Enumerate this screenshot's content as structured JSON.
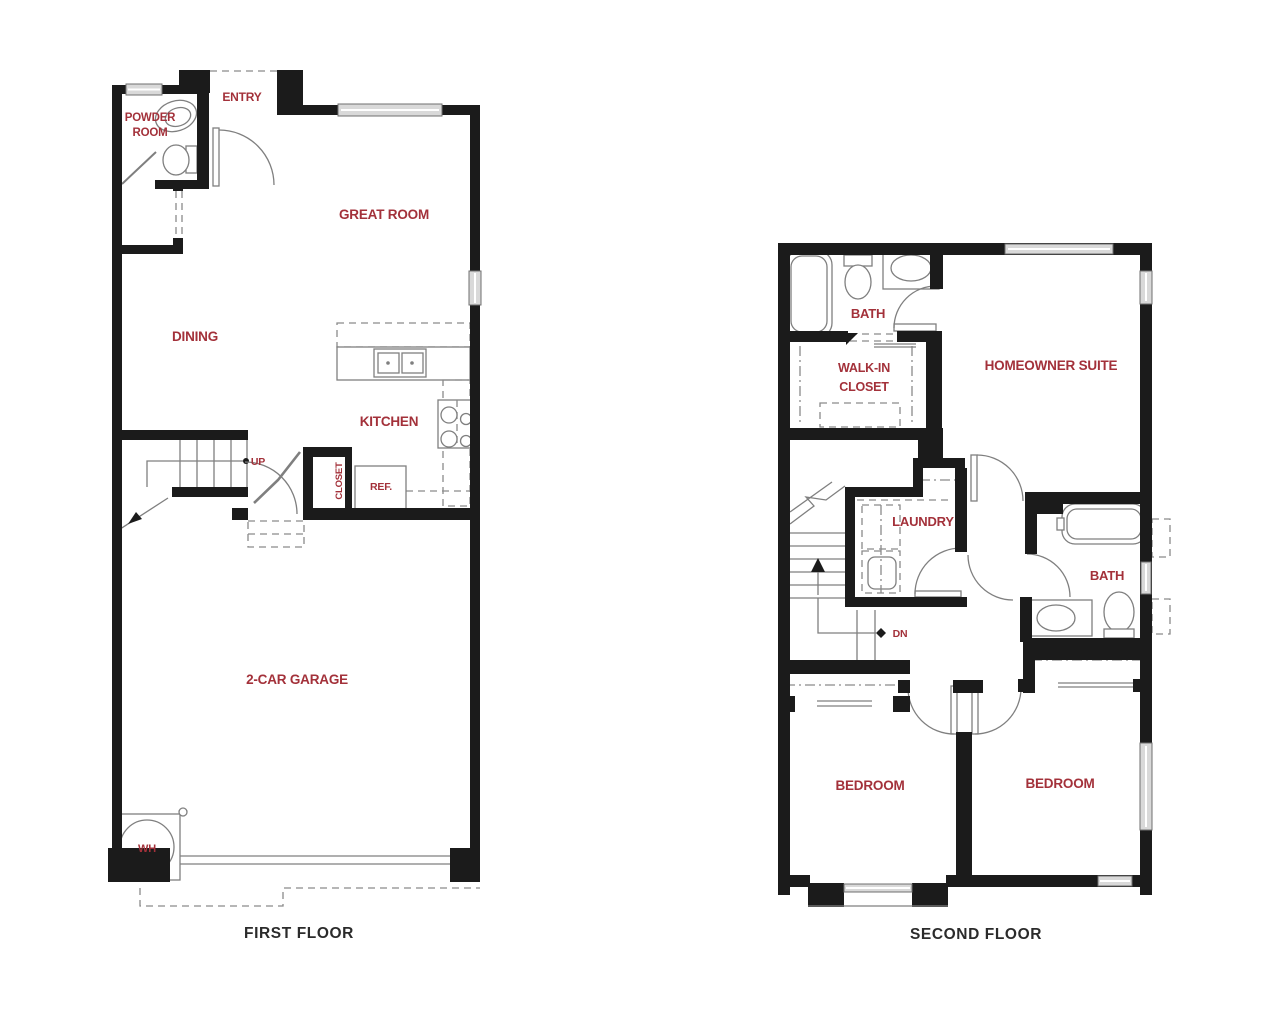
{
  "colors": {
    "wall": "#1b1b1b",
    "line": "#7f7f7f",
    "label_red": "#A3313A",
    "caption_dark": "#2b2b2b"
  },
  "first_floor": {
    "caption": "FIRST FLOOR",
    "rooms": {
      "powder_room": {
        "label_line1": "POWDER",
        "label_line2": "ROOM"
      },
      "entry": {
        "label": "ENTRY"
      },
      "great_room": {
        "label": "GREAT ROOM"
      },
      "dining": {
        "label": "DINING"
      },
      "kitchen": {
        "label": "KITCHEN"
      },
      "closet": {
        "label": "CLOSET"
      },
      "ref": {
        "label": "REF."
      },
      "up": {
        "label": "UP"
      },
      "garage": {
        "label": "2-CAR GARAGE"
      },
      "water_heater": {
        "label": "WH"
      }
    }
  },
  "second_floor": {
    "caption": "SECOND FLOOR",
    "rooms": {
      "bath_upper": {
        "label": "BATH"
      },
      "walk_in_closet": {
        "label_line1": "WALK-IN",
        "label_line2": "CLOSET"
      },
      "homeowner_suite": {
        "label": "HOMEOWNER SUITE"
      },
      "laundry": {
        "label": "LAUNDRY"
      },
      "dn": {
        "label": "DN"
      },
      "bath_hall": {
        "label": "BATH"
      },
      "bedroom_left": {
        "label": "BEDROOM"
      },
      "bedroom_right": {
        "label": "BEDROOM"
      }
    }
  }
}
